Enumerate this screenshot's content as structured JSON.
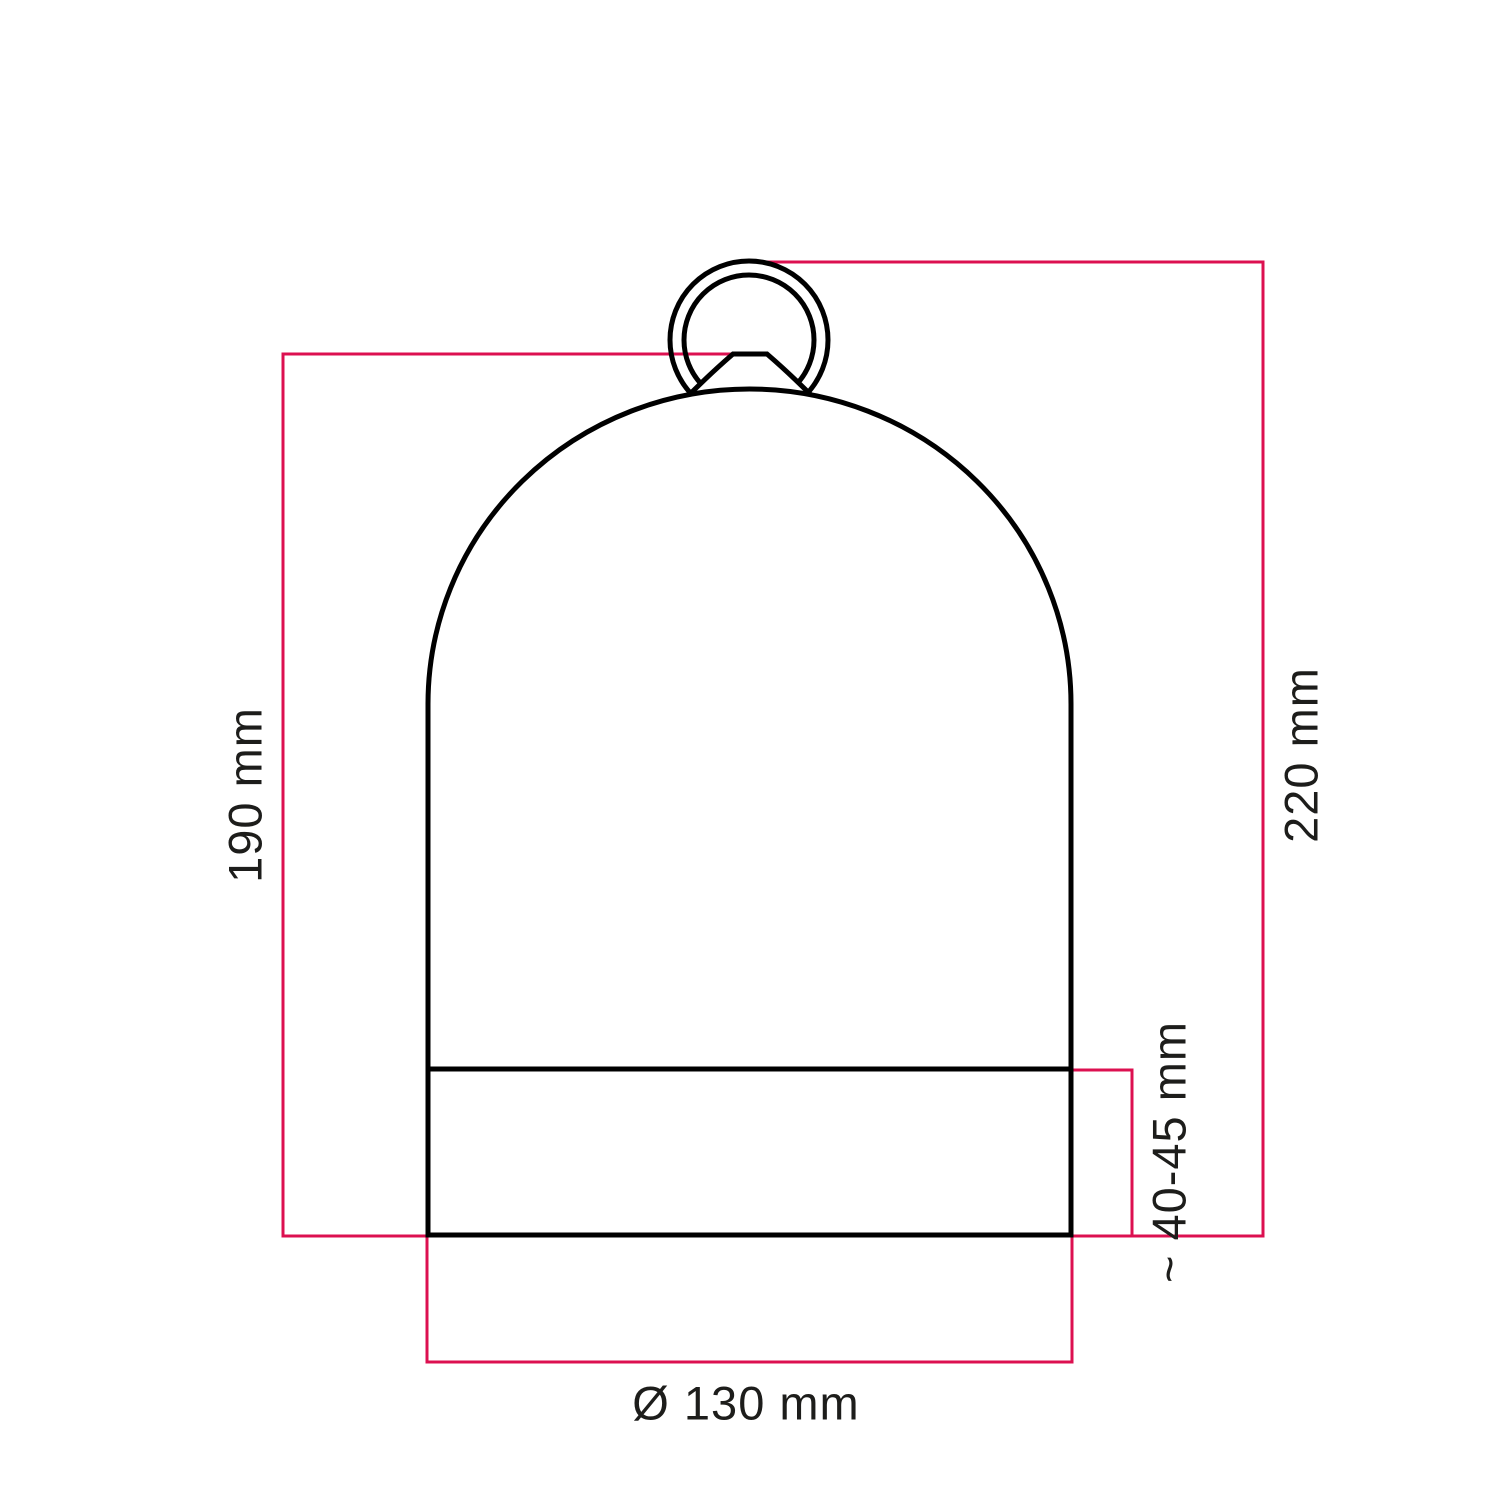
{
  "drawing": {
    "subject": "Bell dome lampshade with hanging ring - technical dimension drawing",
    "colors": {
      "outline": "#000000",
      "dimension_line": "#dc1050",
      "label_text": "#1d1d1b",
      "background": "#ffffff"
    },
    "labels": {
      "body_height": "190 mm",
      "total_height": "220 mm",
      "base_band_height": "~ 40-45 mm",
      "diameter": "Ø 130 mm"
    }
  }
}
